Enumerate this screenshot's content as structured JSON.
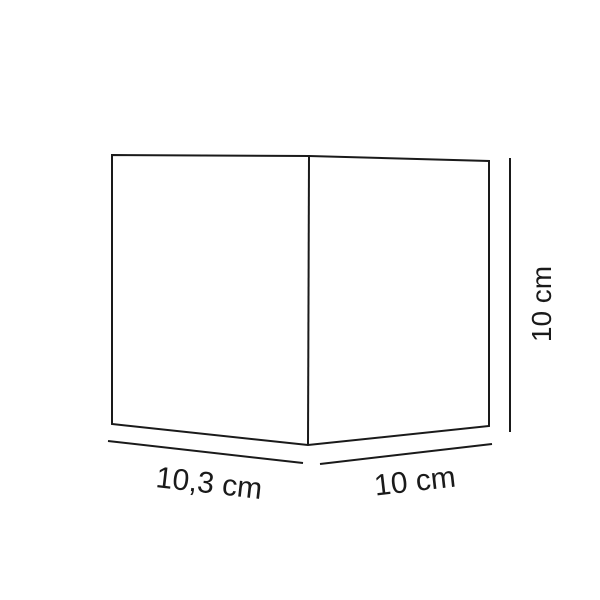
{
  "diagram": {
    "type": "dimensioned-cube-drawing",
    "stroke_color": "#1a1a1a",
    "background_color": "#ffffff",
    "labels": {
      "width": {
        "text": "10,3 cm",
        "position": "bottom-left",
        "rotation_deg": 6.5
      },
      "depth": {
        "text": "10 cm",
        "position": "bottom-right",
        "rotation_deg": -6.5
      },
      "height": {
        "text": "10 cm",
        "position": "right-side",
        "rotation_deg": -90
      }
    }
  }
}
